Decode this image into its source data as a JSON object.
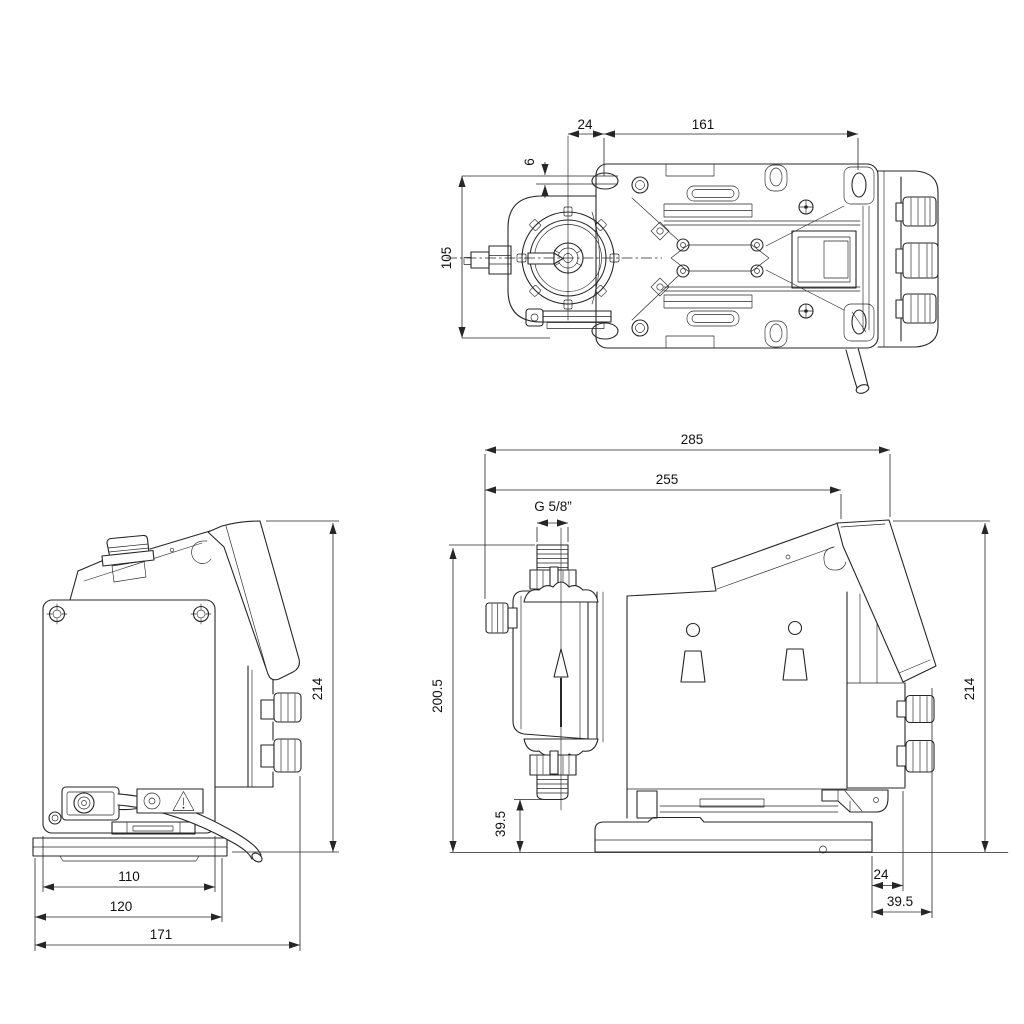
{
  "colors": {
    "background": "#ffffff",
    "line": "#262626",
    "text": "#111111"
  },
  "views": {
    "top": {
      "dims": {
        "head_to_hole": "24",
        "hole_spacing": "161",
        "hole_offset": "6",
        "width": "105"
      }
    },
    "back": {
      "dims": {
        "height": "214",
        "plate_width": "110",
        "base_width": "120",
        "overall_width": "171"
      }
    },
    "side": {
      "dims": {
        "overall_length": "285",
        "length_to_display": "255",
        "thread": "G 5/8”",
        "inlet_height": "200.5",
        "outlet_clearance": "39.5",
        "height": "214",
        "base_to_housing": "24",
        "base_to_display": "39.5"
      }
    }
  }
}
